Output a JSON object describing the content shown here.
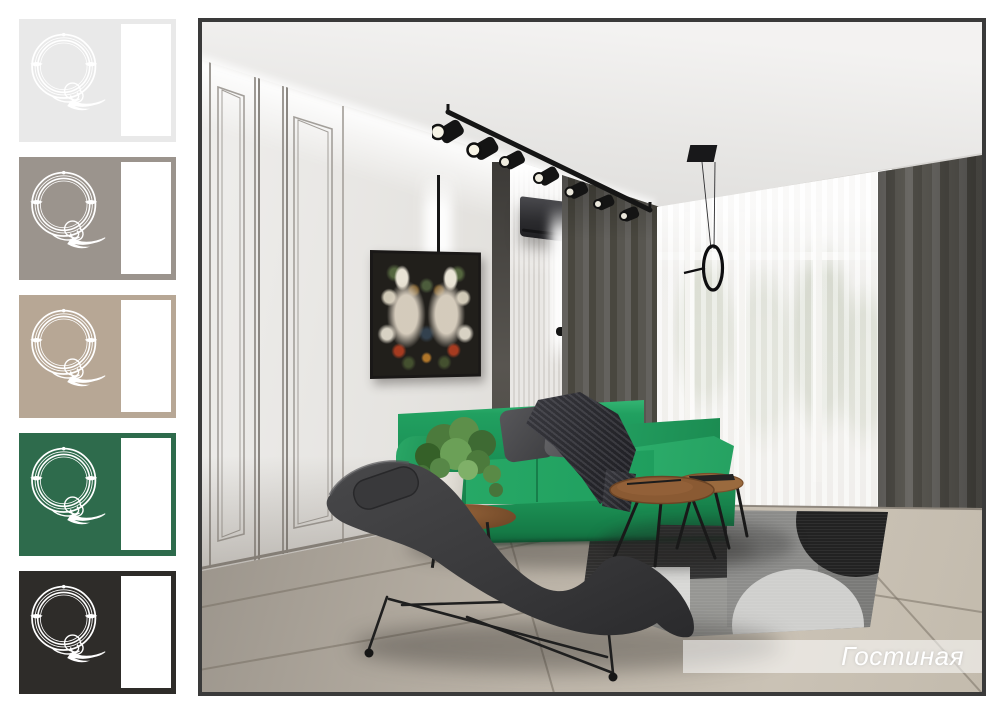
{
  "board": {
    "background": "#ffffff"
  },
  "caption": {
    "label": "Гостиная"
  },
  "swatches": [
    {
      "name": "swatch-light-gray",
      "color": "#e9e9e9",
      "chip": "#ffffff",
      "logo": "#ffffff"
    },
    {
      "name": "swatch-warm-gray",
      "color": "#9b948d",
      "chip": "#ffffff",
      "logo": "#ffffff"
    },
    {
      "name": "swatch-beige",
      "color": "#b7a795",
      "chip": "#ffffff",
      "logo": "#ffffff"
    },
    {
      "name": "swatch-green",
      "color": "#2e6b4c",
      "chip": "#ffffff",
      "logo": "#ffffff"
    },
    {
      "name": "swatch-charcoal",
      "color": "#2e2c29",
      "chip": "#ffffff",
      "logo": "#ffffff"
    }
  ],
  "palette": {
    "frame_border": "#3a3a3a",
    "sofa_green": "#1f9e5e",
    "sofa_green_dark": "#147543",
    "sofa_green_light": "#2eb06d",
    "curtain_dark": "#4d4b45",
    "sheer_light": "#ecebe8",
    "wall_light": "#e4e2df",
    "ceiling_light": "#f3f2f1",
    "floor_beige": "#c0b8ac",
    "floor_dark": "#8f8981",
    "rug_dark": "#343434",
    "rug_mid": "#8d8d8b",
    "rug_light": "#d8d8d6",
    "chaise_gray": "#3a3a3c",
    "wood_brown": "#8a5a33",
    "metal_black": "#1a1a1a",
    "caption_bg": "rgba(255,255,255,0.55)",
    "caption_color": "#ffffff"
  }
}
